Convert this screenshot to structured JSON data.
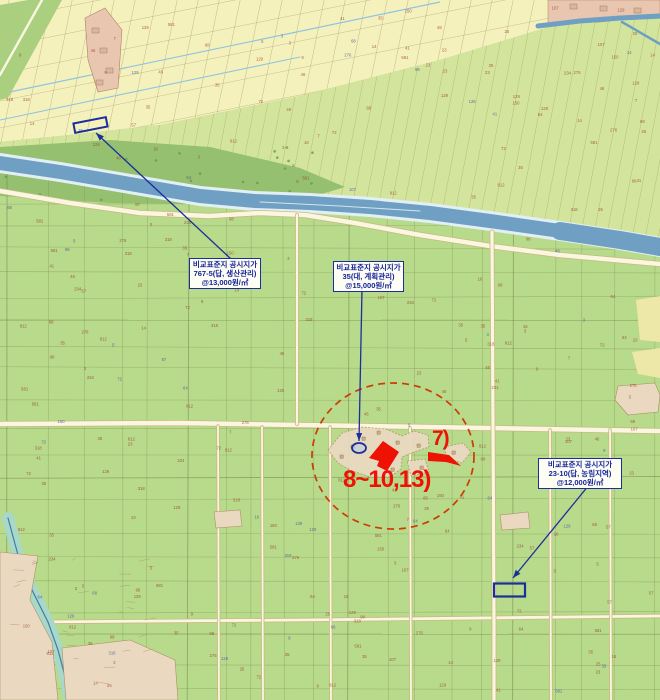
{
  "map": {
    "callouts": [
      {
        "line1": "비교표준지 공시지가",
        "line2": "767-5(답, 생산관리)",
        "line3": "@13,000원/㎡"
      },
      {
        "line1": "비교표준지 공시지가",
        "line2": "35(대, 계획관리)",
        "line3": "@15,000원/㎡"
      },
      {
        "line1": "비교표준지 공시지가",
        "line2": "23-10(답, 농림지역)",
        "line3": "@12,000원/㎡"
      }
    ],
    "highlight_labels": [
      {
        "text": "7)"
      },
      {
        "text": "8~10,13)"
      }
    ],
    "colors": {
      "field_green": "#b7da8b",
      "paddy_yellow": "#f4f1bd",
      "band_green": "#d3e59c",
      "forest_green": "#95c06f",
      "wedge_green": "#a9cf7f",
      "river_blue": "#6fa0c3",
      "river_bank": "#e2eff4",
      "stream_teal": "#a8d8c8",
      "stream_line": "#4878a8",
      "road_fill": "#faf6e0",
      "road_edge": "#c8ba83",
      "village_tan": "#ead9c0",
      "village_pink": "#e9c6b0",
      "building_tan": "#c9ae89",
      "patch_yellow": "#eee8a8",
      "grid_line": "#78804a",
      "highlight_red": "#ee1205",
      "circle_red": "#cf3a05",
      "annotation_blue": "#1b2f9a",
      "parcel_number_red": "#9b3d28",
      "parcel_number_blue": "#44519f",
      "channel_blue": "#8fc4de"
    },
    "parcel_number_samples": [
      "72",
      "14",
      "318",
      "25",
      "46",
      "107",
      "3",
      "581",
      "23",
      "68",
      "150",
      "9",
      "234",
      "57",
      "812",
      "41",
      "16",
      "7",
      "129",
      "35",
      "64",
      "5",
      "98",
      "276"
    ]
  }
}
